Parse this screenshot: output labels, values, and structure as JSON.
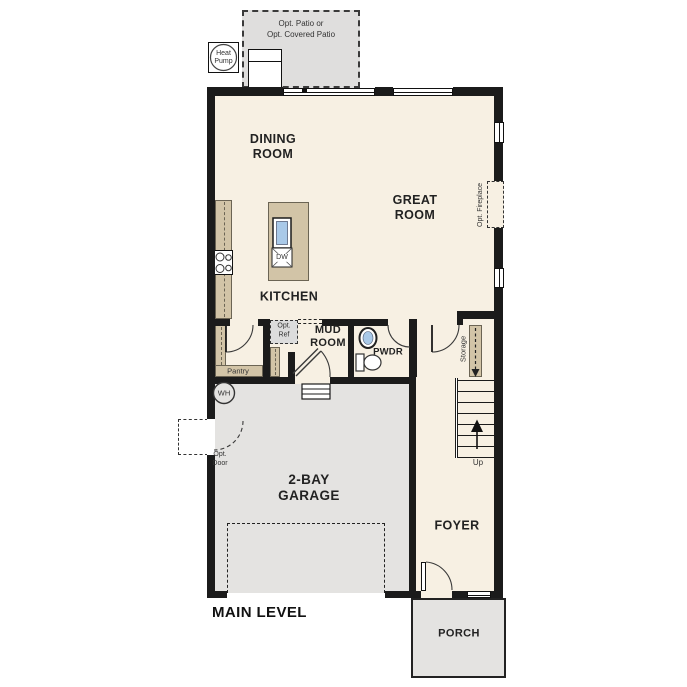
{
  "title": {
    "main_level": "MAIN LEVEL"
  },
  "rooms": {
    "dining": {
      "line1": "DINING",
      "line2": "ROOM"
    },
    "great": {
      "line1": "GREAT",
      "line2": "ROOM"
    },
    "kitchen": {
      "label": "KITCHEN"
    },
    "mud": {
      "line1": "MUD",
      "line2": "ROOM"
    },
    "pwdr": {
      "label": "PWDR"
    },
    "garage": {
      "line1": "2-BAY",
      "line2": "GARAGE"
    },
    "foyer": {
      "label": "FOYER"
    },
    "porch": {
      "label": "PORCH"
    },
    "pantry": {
      "label": "Pantry"
    },
    "storage": {
      "label": "Storage"
    }
  },
  "annotations": {
    "patio": {
      "line1": "Opt. Patio or",
      "line2": "Opt. Covered Patio"
    },
    "heat_pump": {
      "line1": "Heat",
      "line2": "Pump"
    },
    "opt_fireplace": "Opt. Fireplace",
    "opt_ref": {
      "line1": "Opt.",
      "line2": "Ref"
    },
    "opt_door": {
      "line1": "Opt.",
      "line2": "Door"
    },
    "dishwasher": "DW",
    "water_heater": "WH",
    "stairs_up": "Up"
  },
  "colors": {
    "wall": "#1b1b1b",
    "floor": "#f7f0e3",
    "garage": "#e4e3e1",
    "patio": "#dfdedd",
    "counter": "#d2c4a7",
    "sink": "#a9c9e8",
    "text": "#222222"
  }
}
